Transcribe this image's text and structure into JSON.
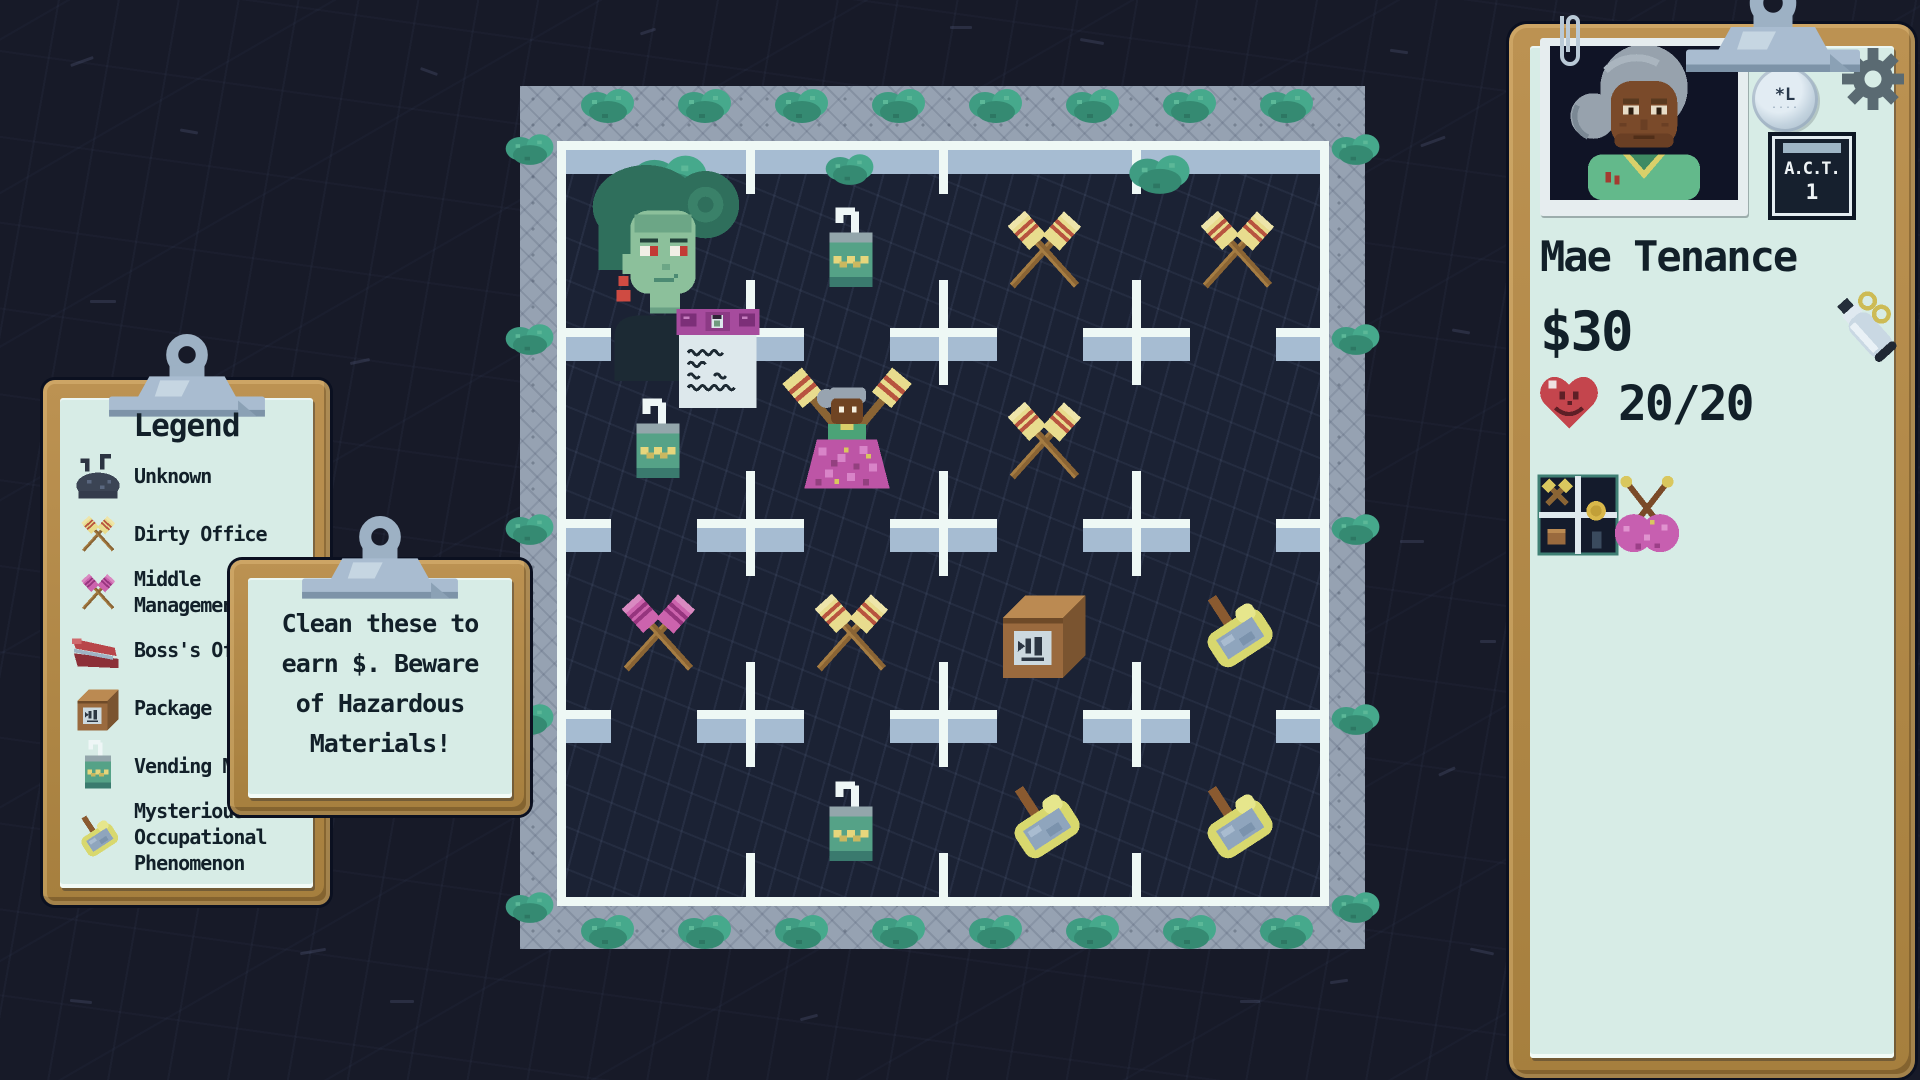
{
  "legend": {
    "title": "Legend",
    "items": [
      {
        "icon": "unknown-blob-icon",
        "label": "Unknown"
      },
      {
        "icon": "dirty-office-icon",
        "label": "Dirty Office"
      },
      {
        "icon": "middle-management-icon",
        "label": "Middle Management"
      },
      {
        "icon": "boss-office-icon",
        "label": "Boss's Office"
      },
      {
        "icon": "package-icon",
        "label": "Package"
      },
      {
        "icon": "vending-machine-icon",
        "label": "Vending Machine"
      },
      {
        "icon": "mop-icon",
        "label": "Mysterious Occupational Phenomenon"
      }
    ]
  },
  "tooltip": {
    "lines": [
      "Clean these to",
      "earn $. Beware",
      "of Hazardous",
      "Materials!"
    ]
  },
  "board": {
    "rows": 4,
    "cols": 4,
    "cells": [
      [
        "",
        "vending-machine-icon",
        "dirty-office-icon",
        "dirty-office-icon"
      ],
      [
        "vending-machine-icon",
        "",
        "dirty-office-icon",
        ""
      ],
      [
        "middle-management-icon",
        "dirty-office-icon",
        "package-icon",
        "mop-icon"
      ],
      [
        "",
        "vending-machine-icon",
        "mop-icon",
        "mop-icon"
      ]
    ],
    "overlays": [
      {
        "sprite": "npc-portrait",
        "row": 0,
        "col": 0
      },
      {
        "sprite": "memo-note",
        "row": 0,
        "col": 0
      },
      {
        "sprite": "player-character",
        "row": 1,
        "col": 1
      }
    ]
  },
  "character_panel": {
    "name": "Mae Tenance",
    "money": "$30",
    "health": "20/20",
    "act_label": "A.C.T.",
    "act_value": "1",
    "pin_label": "*L",
    "pin_dots": "....",
    "inventory": [
      {
        "icon": "cleaned-rooms-thumbnail"
      },
      {
        "icon": "knitting-icon"
      }
    ]
  },
  "colors": {
    "background": "#171a28",
    "paper": "#d7ece6",
    "wood": "#b28947",
    "board_cell": "#1b2234",
    "wall": "#eef8f5",
    "wall_cap": "#a6bcd2",
    "frame": "#96a2b2",
    "bush": "#46a98c",
    "broom_yellow": "#e8dc8e",
    "broom_pink": "#cc63ad",
    "heart_red": "#c4454d",
    "text_dark": "#122029"
  }
}
